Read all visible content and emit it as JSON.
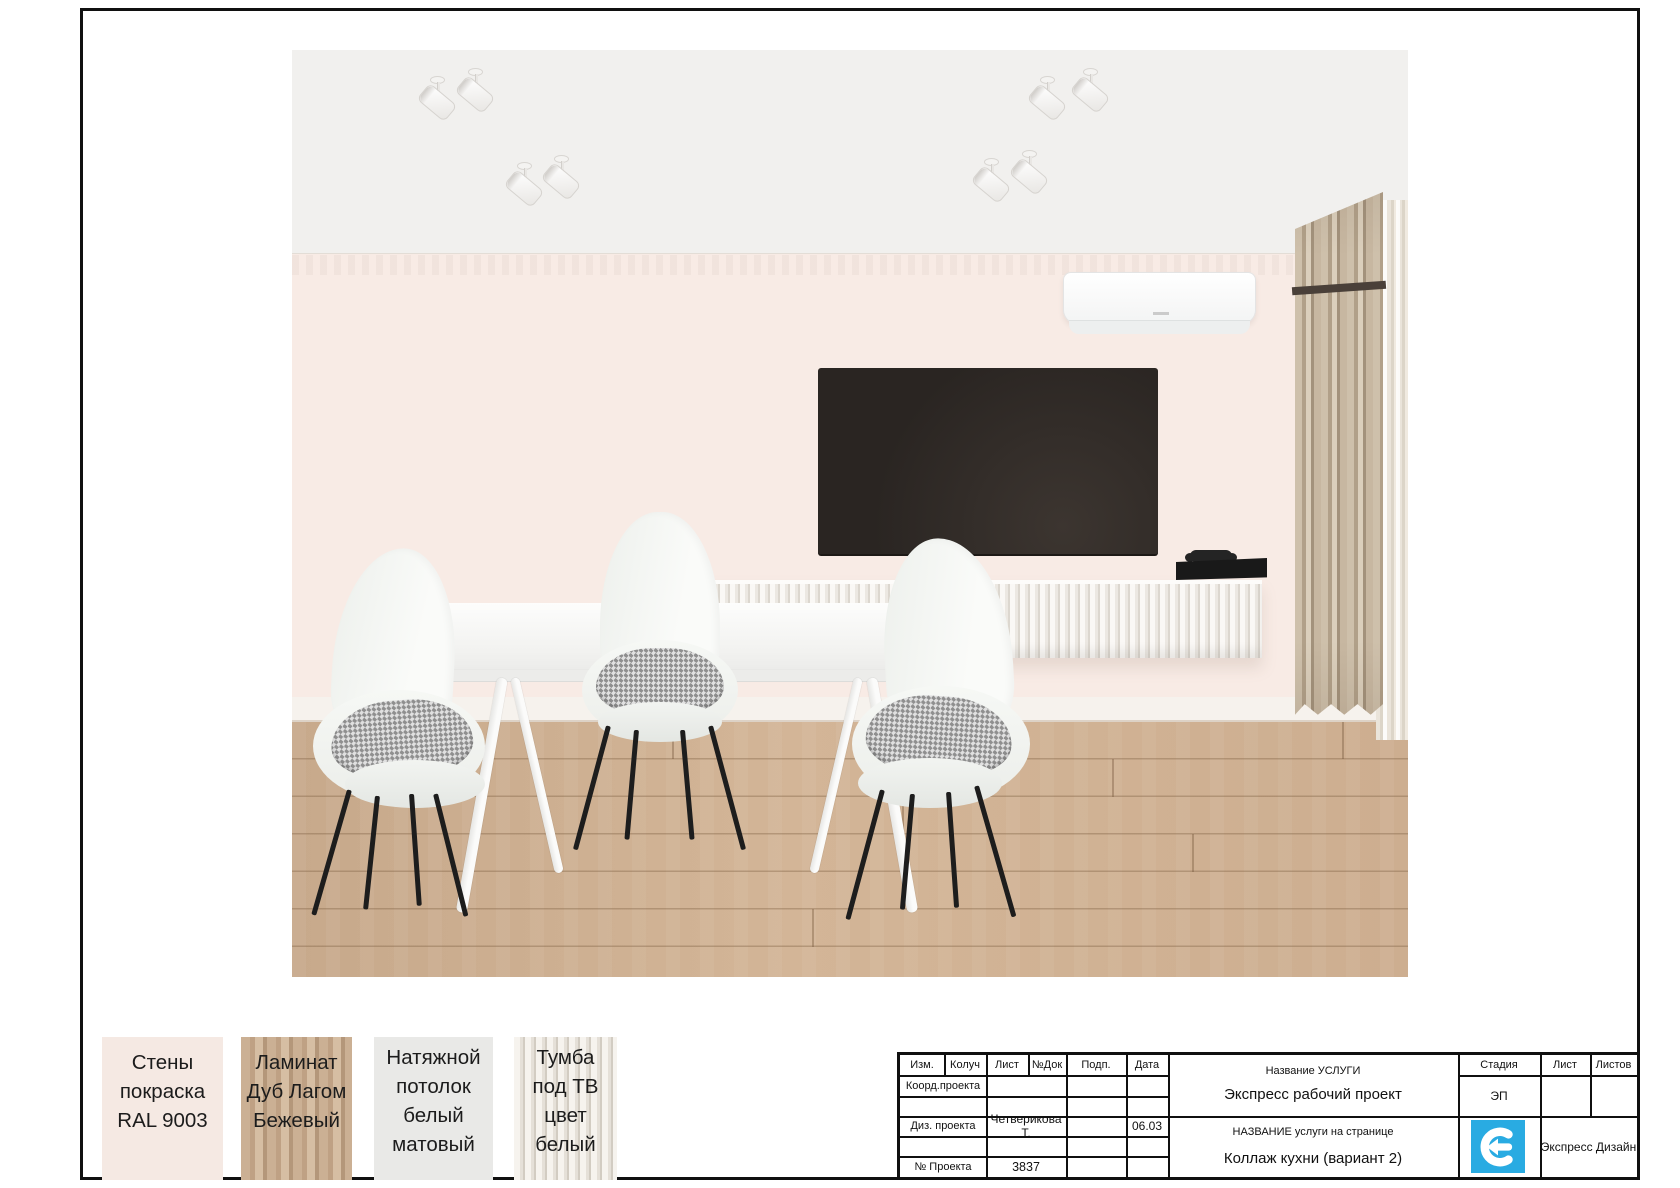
{
  "materials": [
    {
      "name": "wall-paint",
      "lines": [
        "Стены",
        "покраска",
        "RAL 9003"
      ]
    },
    {
      "name": "laminate",
      "lines": [
        "Ламинат",
        "Дуб Лагом",
        "Бежевый"
      ]
    },
    {
      "name": "stretch-ceiling",
      "lines": [
        "Натяжной",
        "потолок",
        "белый",
        "матовый"
      ]
    },
    {
      "name": "tv-cabinet",
      "lines": [
        "Тумба",
        "под ТВ",
        "цвет",
        "белый"
      ]
    }
  ],
  "title_block": {
    "cols": {
      "izm": "Изм.",
      "koluch": "Колуч",
      "list": "Лист",
      "ndok": "№Док",
      "podp": "Подп.",
      "data": "Дата"
    },
    "coord_label": "Коорд.проекта",
    "diz_label": "Диз. проекта",
    "diz_value": "Четверикова Т.",
    "diz_date": "06.03",
    "project_label": "№ Проекта",
    "project_number": "3837",
    "service_caption": "Название УСЛУГИ",
    "service_value": "Экспресс рабочий проект",
    "page_caption": "НАЗВАНИЕ услуги на странице",
    "page_value": "Коллаж кухни (вариант 2)",
    "stage_label": "Стадия",
    "stage_value": "ЭП",
    "sheet_label": "Лист",
    "sheets_label": "Листов",
    "brand": "Экспресс Дизайн",
    "brand_color": "#29abe2"
  },
  "scene": {
    "colors": {
      "ceiling": "#f1f0ee",
      "wall": "#f8ebe5",
      "floor": "#cdae90",
      "curtain": "#c4b29c",
      "tv": "#2e2927",
      "accent": "#29abe2"
    },
    "objects": [
      "ceiling-spotlights",
      "air-conditioner",
      "tv",
      "game-console",
      "fluted-tv-stand",
      "curtain",
      "dining-table",
      "chairs"
    ]
  }
}
